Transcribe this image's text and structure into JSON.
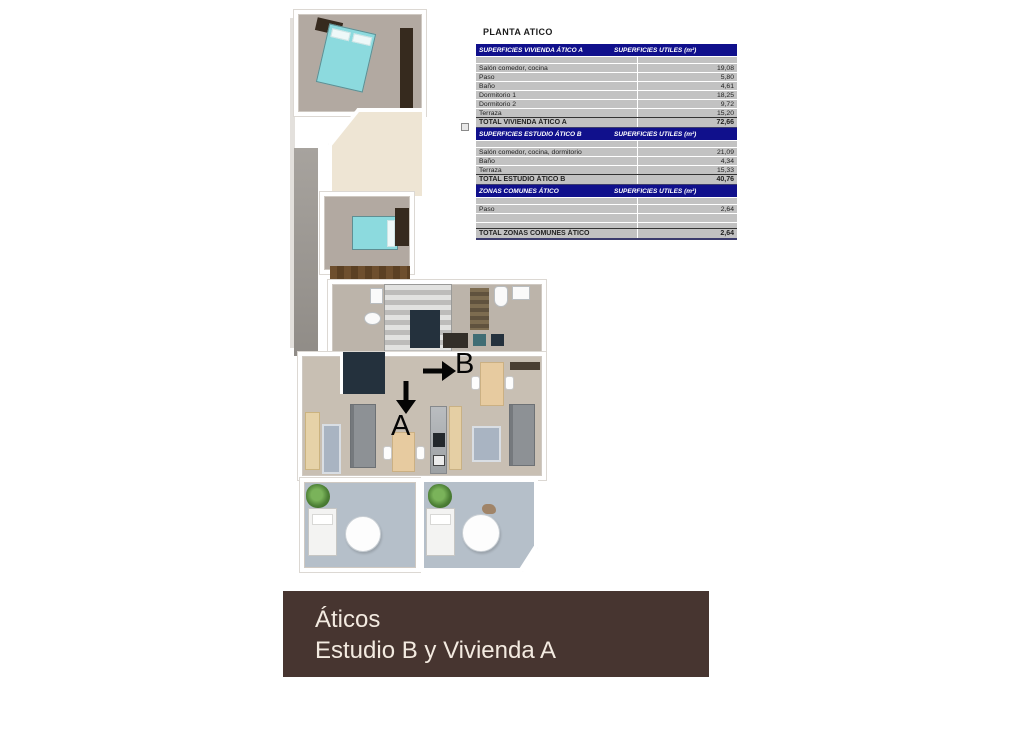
{
  "panel": {
    "title": "PLANTA ATICO"
  },
  "tables": [
    {
      "title": "SUPERFICIES VIVIENDA ÁTICO A",
      "units_header": "SUPERFICIES UTILES  (m²)",
      "rows": [
        {
          "label": "Salón comedor, cocina",
          "value": "19,08"
        },
        {
          "label": "Paso",
          "value": "5,80"
        },
        {
          "label": "Baño",
          "value": "4,61"
        },
        {
          "label": "Dormitorio 1",
          "value": "18,25"
        },
        {
          "label": "Dormitorio 2",
          "value": "9,72"
        },
        {
          "label": "Terraza",
          "value": "15,20"
        }
      ],
      "total": {
        "label": "TOTAL VIVIENDA ÁTICO A",
        "value": "72,66"
      }
    },
    {
      "title": "SUPERFICIES ESTUDIO ÁTICO B",
      "units_header": "SUPERFICIES UTILES  (m²)",
      "rows": [
        {
          "label": "Salón comedor, cocina, dormitorio",
          "value": "21,09"
        },
        {
          "label": "Baño",
          "value": "4,34"
        },
        {
          "label": "Terraza",
          "value": "15,33"
        }
      ],
      "total": {
        "label": "TOTAL ESTUDIO ÁTICO B",
        "value": "40,76"
      }
    },
    {
      "title": "ZONAS COMUNES ÁTICO",
      "units_header": "SUPERFICIES UTILES  (m²)",
      "rows": [
        {
          "label": "Paso",
          "value": "2,64"
        }
      ],
      "total": {
        "label": "TOTAL ZONAS COMUNES ÁTICO",
        "value": "2,64"
      }
    }
  ],
  "floorplan": {
    "unit_a_label": "A",
    "unit_b_label": "B"
  },
  "banner": {
    "line1": "Áticos",
    "line2": "Estudio B y Vivienda A"
  },
  "colors": {
    "table_header_bg": "#10108c",
    "table_row_bg": "#c2c2c2",
    "banner_bg": "#473530",
    "banner_fg": "#f3eae0",
    "carpet": "#b2a9a1",
    "living_floor": "#c8bfb3",
    "terrace_floor": "#b5bfc9",
    "cream_floor": "#eee5d4",
    "bed": "#8cdade",
    "wardrobe": "#362a1e",
    "navy": "#24313d",
    "sofa": "#8d9195",
    "table_wood": "#e7cba0",
    "rug": "#a9b4c2",
    "plant": "#4c7f35"
  }
}
